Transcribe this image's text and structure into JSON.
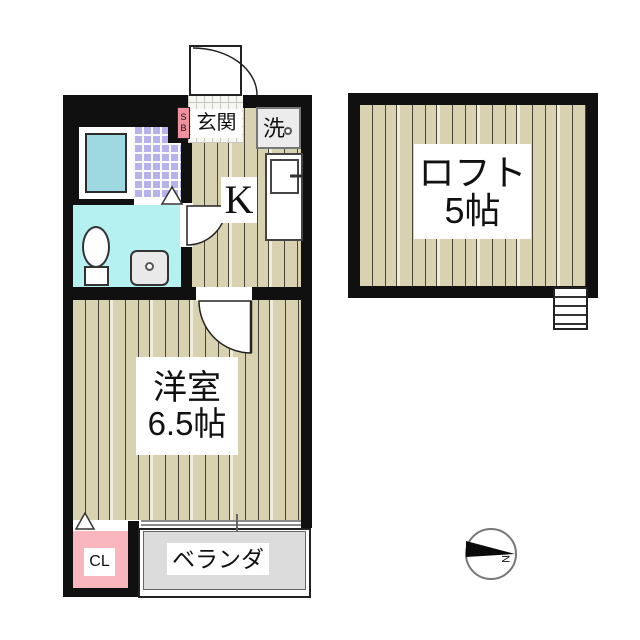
{
  "unit": {
    "entrance": "玄関",
    "shoe_box": "SB",
    "washer": "洗",
    "kitchen": "K",
    "room_name": "洋室",
    "room_size": "6.5帖",
    "closet": "CL",
    "veranda": "ベランダ"
  },
  "loft": {
    "name": "ロフト",
    "size": "5帖"
  },
  "compass": {
    "north": "N"
  },
  "colors": {
    "wall": "#101010",
    "wood_floor": "#d8d2b0",
    "shower_tile": "#b6b3ec",
    "bathtub": "#9ed9e1",
    "toilet_room": "#b5f1f1",
    "closet_pink": "#f9b6bc",
    "shoe_box_pink": "#f0919e",
    "veranda_gray": "#dcdcdc"
  }
}
